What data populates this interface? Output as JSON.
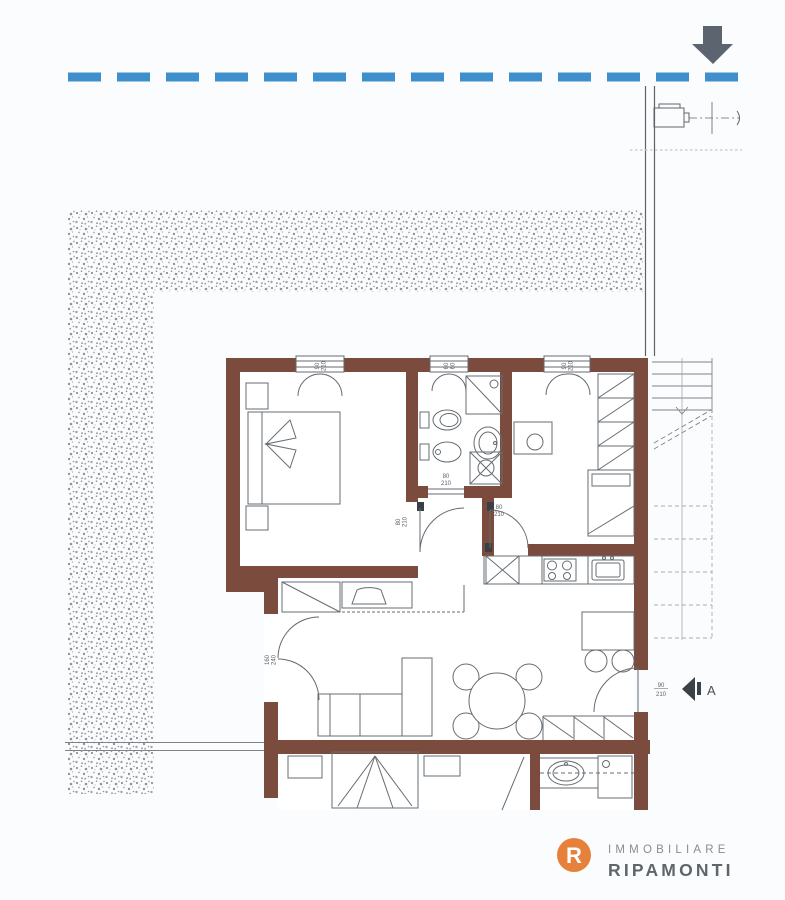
{
  "colors": {
    "wall": "#7B4B3E",
    "boundary_blue": "#3E8FCB",
    "arrow": "#5C6470",
    "furniture_line": "#666C72",
    "stipple_dot": "#8E949A",
    "logo_orange": "#E5813A",
    "logo_name": "#5F656B",
    "logo_tag": "#888D92"
  },
  "dim_labels": {
    "window_bedroom1": {
      "w": "90",
      "h": "210"
    },
    "window_bathroom": {
      "w": "60",
      "h": "60"
    },
    "window_bedroom2": {
      "w": "90",
      "h": "210"
    },
    "door_bedroom1": {
      "w": "80",
      "h": "210"
    },
    "door_bedroom2": {
      "w": "80",
      "h": "210"
    },
    "door_sliding": {
      "w": "80",
      "h": "210"
    },
    "door_terrace": {
      "w": "90",
      "h": "210"
    },
    "door_entry": {
      "w": "160",
      "h": "240"
    }
  },
  "section_marker": {
    "label": "A"
  },
  "logo": {
    "monogram": "R",
    "tagline": "IMMOBILIARE",
    "name": "RIPAMONTI"
  }
}
